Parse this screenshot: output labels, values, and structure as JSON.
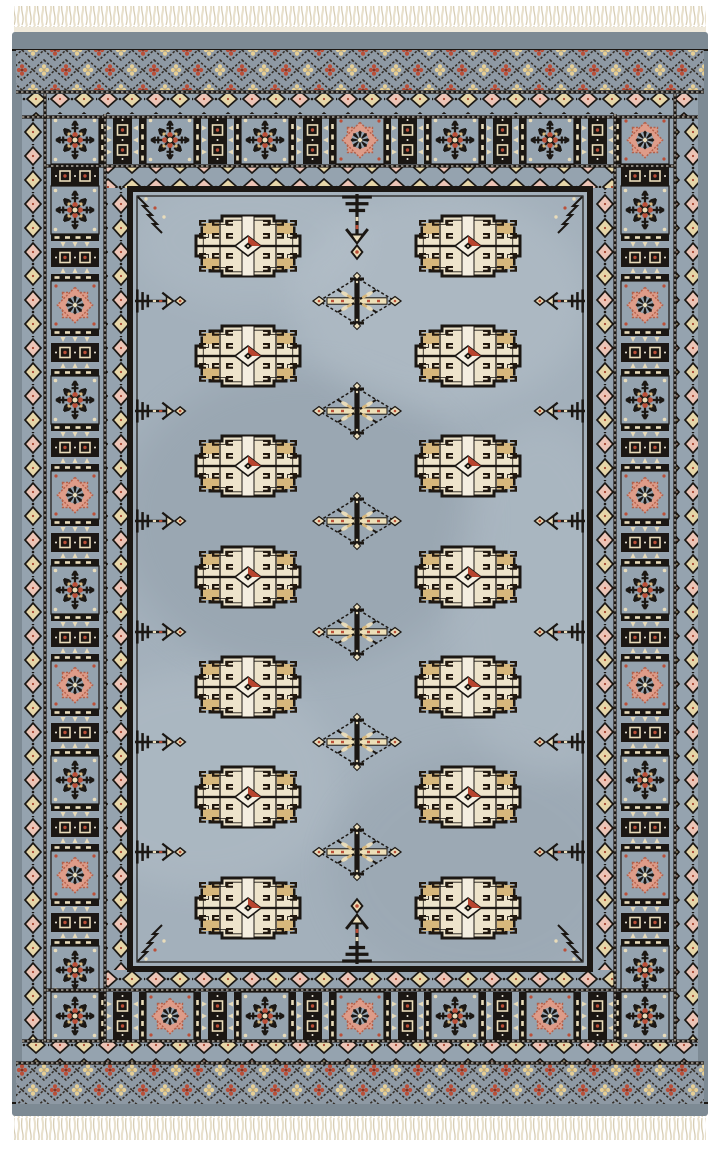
{
  "scene": {
    "type": "photograph",
    "subject": "hand-knotted Bokhara oriental rug on white background",
    "orientation": "vertical, fringe at top and bottom"
  },
  "palette": {
    "page_bg": "#ffffff",
    "fringe": "#e9e1cd",
    "fringe2": "#d7cdb4",
    "kilim": "#efe9db",
    "selvage": "#7d8a94",
    "band_bg": "#95a3af",
    "lattice_bg": "#8e99a4",
    "lattice_line": "#332d26",
    "field": "#a3b0bb",
    "mottle_light": "#bdc8d0",
    "mottle_dark": "#86939f",
    "black": "#1b1713",
    "cream": "#e9dcba",
    "cream_light": "#e6d6a8",
    "tan": "#d7b77c",
    "white_knot": "#f4eee0",
    "red": "#a8432f",
    "red_bright": "#bb4f38",
    "salmon": "#de9c89",
    "salmon_dark": "#b4604a",
    "pink_light": "#ecc4b6"
  },
  "rug": {
    "x": 12,
    "y": 32,
    "w": 696,
    "h": 1084
  },
  "fringe": {
    "top": {
      "y": 6,
      "h": 26
    },
    "bottom": {
      "y": 1114,
      "h": 26
    }
  },
  "field": {
    "rect": {
      "x": 133,
      "y": 192,
      "w": 454,
      "h": 774
    },
    "guls": {
      "count": 14,
      "columns": [
        248,
        468
      ],
      "rows": [
        246,
        356,
        466,
        577,
        687,
        797,
        908
      ],
      "w": 104,
      "h": 60
    },
    "diamonds": {
      "count": 6,
      "x": 357,
      "ys": [
        301,
        411,
        521,
        632,
        742,
        852
      ]
    },
    "edge_pendants": {
      "per_side": 6,
      "ys": [
        301,
        411,
        521,
        632,
        742,
        852
      ]
    },
    "center_pendants": {
      "x": 357,
      "top_y": 192,
      "bottom_y": 966
    }
  },
  "borders": {
    "outer_lattice_rows": 2,
    "main_border": {
      "top_figures": [
        {
          "x": 75,
          "type": "star"
        },
        {
          "x": 170,
          "type": "star"
        },
        {
          "x": 265,
          "type": "star"
        },
        {
          "x": 360,
          "type": "rosette"
        },
        {
          "x": 455,
          "type": "star"
        },
        {
          "x": 550,
          "type": "star"
        },
        {
          "x": 645,
          "type": "rosette"
        }
      ],
      "bottom_figures": [
        {
          "x": 75,
          "type": "star"
        },
        {
          "x": 170,
          "type": "rosette"
        },
        {
          "x": 265,
          "type": "star"
        },
        {
          "x": 360,
          "type": "rosette"
        },
        {
          "x": 455,
          "type": "star"
        },
        {
          "x": 550,
          "type": "rosette"
        },
        {
          "x": 645,
          "type": "star"
        }
      ],
      "side_figures": [
        {
          "y": 210,
          "type": "star"
        },
        {
          "y": 305,
          "type": "rosette"
        },
        {
          "y": 400,
          "type": "star"
        },
        {
          "y": 495,
          "type": "rosette"
        },
        {
          "y": 590,
          "type": "star"
        },
        {
          "y": 685,
          "type": "rosette"
        },
        {
          "y": 780,
          "type": "star"
        },
        {
          "y": 875,
          "type": "rosette"
        },
        {
          "y": 970,
          "type": "star"
        }
      ]
    }
  }
}
